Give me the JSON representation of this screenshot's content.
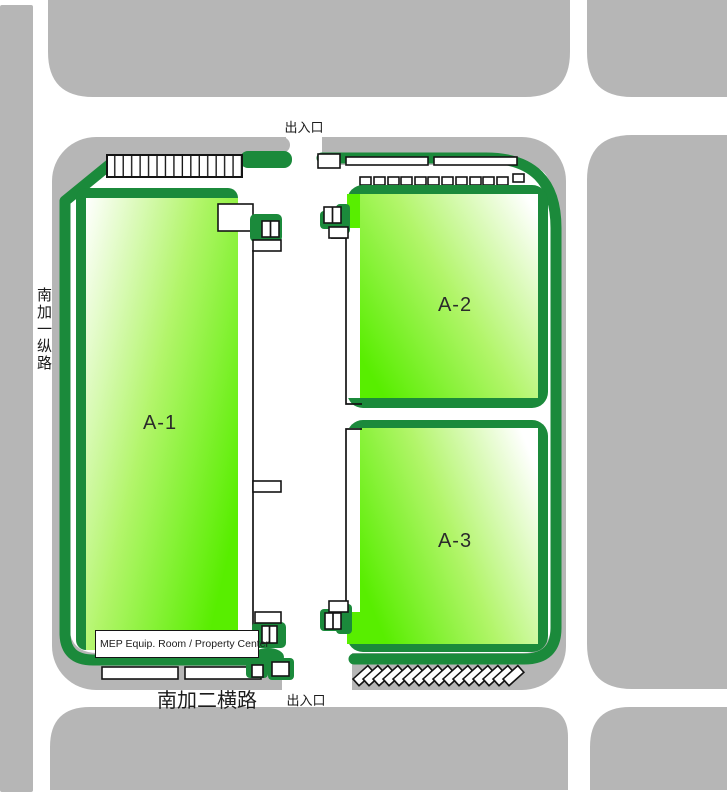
{
  "plan": {
    "title": "工厂园区总平面图",
    "buildings": [
      {
        "label": "A-1"
      },
      {
        "label": "A-2"
      },
      {
        "label": "A-3"
      }
    ],
    "entrances": [
      {
        "label": "出入口",
        "position": "top"
      },
      {
        "label": "出入口",
        "position": "bottom"
      }
    ],
    "roads": [
      {
        "label": "南加一纵路",
        "orientation": "vertical"
      },
      {
        "label": "南加二横路",
        "orientation": "horizontal"
      }
    ],
    "facilities": [
      {
        "label": "MEP Equip. Room / Property Center"
      }
    ],
    "colors": {
      "city_block_gray": "#b6b6b6",
      "landscape_dark_green": "#1b8a3b",
      "building_bright_green": "#58ee00",
      "road_white": "#ffffff",
      "outline_black": "#141414"
    }
  }
}
